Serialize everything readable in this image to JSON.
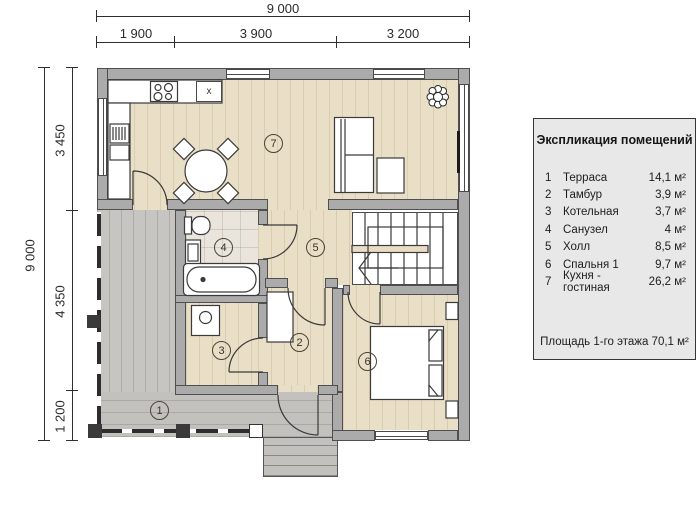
{
  "dimensions": {
    "top": {
      "total": "9 000",
      "segments": [
        "1 900",
        "3 900",
        "3 200"
      ]
    },
    "left": {
      "total": "9 000",
      "segments": [
        "3 450",
        "4 350",
        "1 200"
      ]
    }
  },
  "plan": {
    "sink_mark": "x"
  },
  "legend": {
    "title": "Экспликация помещений",
    "rows": [
      {
        "num": "1",
        "name": "Терраса",
        "area": "14,1 м²"
      },
      {
        "num": "2",
        "name": "Тамбур",
        "area": "3,9 м²"
      },
      {
        "num": "3",
        "name": "Котельная",
        "area": "3,7 м²"
      },
      {
        "num": "4",
        "name": "Санузел",
        "area": "4 м²"
      },
      {
        "num": "5",
        "name": "Холл",
        "area": "8,5 м²"
      },
      {
        "num": "6",
        "name": "Спальня 1",
        "area": "9,7 м²"
      },
      {
        "num": "7",
        "name": "Кухня - гостиная",
        "area": "26,2 м²"
      }
    ],
    "footer": "Площадь 1-го этажа 70,1 м²"
  },
  "colors": {
    "wall": "#ababab",
    "wall_border": "#4f4f4f",
    "wood_floor": "#e9dec6",
    "tile_floor": "#eae5dc",
    "terrace": "#c7c5c1",
    "line": "#3a3a3a",
    "legend_bg": "#e8e8e8"
  }
}
